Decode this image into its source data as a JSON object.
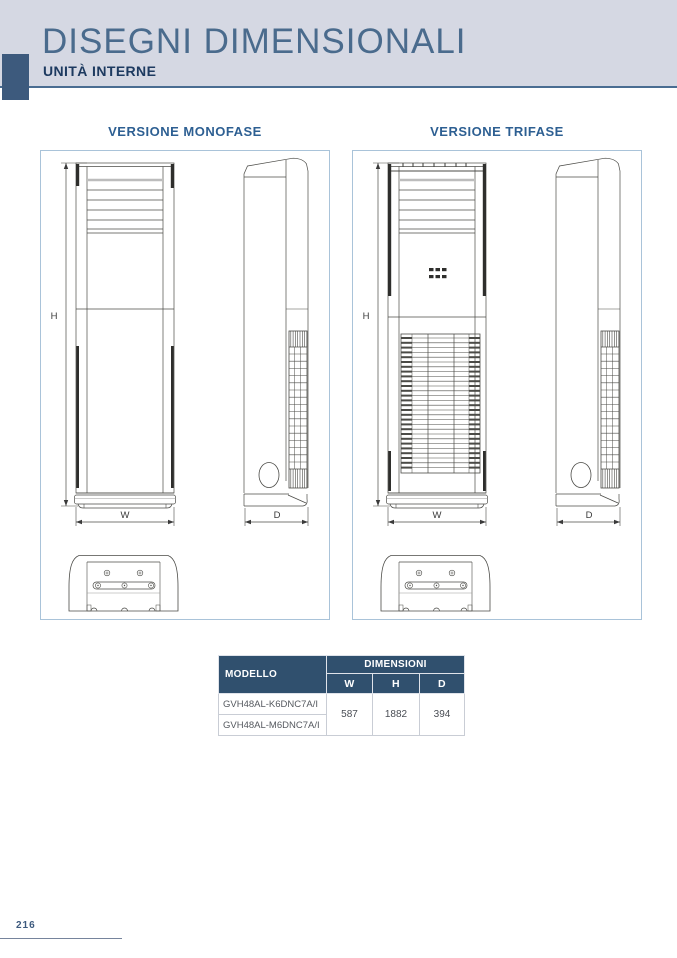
{
  "page": {
    "title": "DISEGNI DIMENSIONALI",
    "subtitle": "UNITÀ INTERNE",
    "page_number": "216"
  },
  "sections": [
    {
      "label": "VERSIONE MONOFASE"
    },
    {
      "label": "VERSIONE TRIFASE"
    }
  ],
  "drawings": {
    "dim_labels": {
      "w": "W",
      "h": "H",
      "d": "D"
    }
  },
  "table": {
    "header": {
      "modello": "MODELLO",
      "dimensioni": "DIMENSIONI",
      "cols": [
        "W",
        "H",
        "D"
      ]
    },
    "rows": [
      {
        "modello": "GVH48AL-K6DNC7A/I"
      },
      {
        "modello": "GVH48AL-M6DNC7A/I"
      }
    ],
    "values": {
      "w": "587",
      "h": "1882",
      "d": "394"
    }
  },
  "colors": {
    "band_bg": "#d5d8e3",
    "accent": "#3d5a7d",
    "title": "#4a6b8d",
    "subtitle": "#1d3a60",
    "section_label": "#2d5f92",
    "box_border": "#a9c3d9",
    "table_header_bg": "#30506e",
    "drawing_stroke": "#4b4b47"
  }
}
